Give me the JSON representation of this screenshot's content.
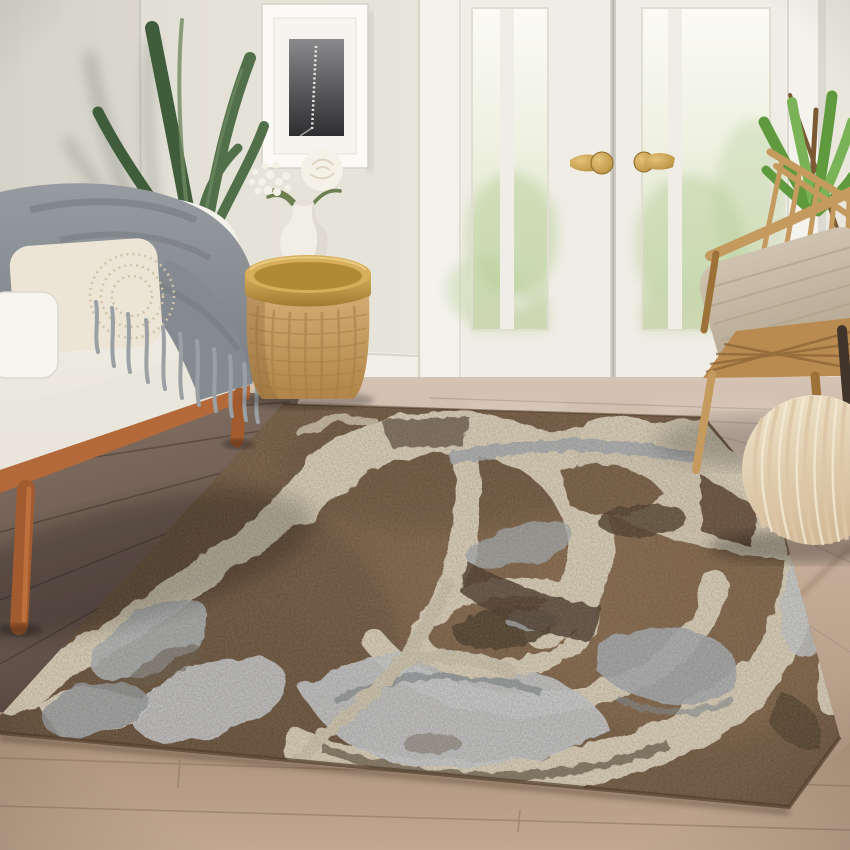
{
  "scene": {
    "type": "living-room-photograph",
    "subject": "brown abstract antler-pattern area rug styled in a bright living room",
    "objects": [
      {
        "name": "wall"
      },
      {
        "name": "wall-corner"
      },
      {
        "name": "framed-botanical-art"
      },
      {
        "name": "potted-plant-left"
      },
      {
        "name": "french-doors"
      },
      {
        "name": "garden-view"
      },
      {
        "name": "brass-door-handles"
      },
      {
        "name": "baseboard"
      },
      {
        "name": "white-loveseat"
      },
      {
        "name": "gray-knit-throw"
      },
      {
        "name": "cream-lumbar-pillow"
      },
      {
        "name": "white-side-pillow"
      },
      {
        "name": "wicker-drum-side-table"
      },
      {
        "name": "gold-tray"
      },
      {
        "name": "white-vase"
      },
      {
        "name": "white-flowers"
      },
      {
        "name": "rattan-armchair"
      },
      {
        "name": "beige-chair-cushion"
      },
      {
        "name": "potted-plant-right"
      },
      {
        "name": "knitted-pouf"
      },
      {
        "name": "wood-floor"
      },
      {
        "name": "area-rug"
      }
    ],
    "palette": {
      "wall": "#e6e3d9",
      "cornerLine": "#c9c6bb",
      "baseboard": "#f1efe7",
      "baseboardEdge": "#d8d4c8",
      "doorWhite": "#f4f2ec",
      "doorStile": "#efede5",
      "doorShadow": "#d9d5c9",
      "seam": "#b7b2a5",
      "glassTop": "#fbfbf4",
      "glassMid": "#eef0e0",
      "glassLow": "#dfe7cd",
      "lawn": "#ccd7b2",
      "tree": "#b9cf9b",
      "brassLight": "#e3c279",
      "brass": "#c29a4b",
      "brassDark": "#8c6a28",
      "floorLightTop": "#d4c2b3",
      "floorLight": "#c0a791",
      "floorDarkTop": "#8a7668",
      "floorDark": "#574840",
      "plank": "#3f332a",
      "floorBottomTop": "#a88e76",
      "floorBottom": "#c2a890",
      "plankLight": "#8d7460",
      "rugBase": "#6e5339",
      "rugDark": "#41301f",
      "rugDeep": "#2f2418",
      "rugLight": "#8d6c4b",
      "cream": "#dbd1ba",
      "creamBright": "#e9e1cd",
      "creamDim": "#cfc6b0",
      "gray": "#a3aab1",
      "grayLight": "#c6cbd0",
      "grayDark": "#7c848d",
      "grayBrown": "#6b6158",
      "sofa": "#f5f3ed",
      "sofaShade": "#e7e3d8",
      "rail": "#b4693a",
      "legWood": "#a25a2f",
      "throw": "#8d9296",
      "throwDark": "#707579",
      "fringe": "#9aa0a4",
      "pillow": "#ece5d5",
      "pillowDot": "#cfc2a8",
      "pillowWhite": "#f7f5ef",
      "wicker": "#cba46c",
      "wickerLine": "#a87f47",
      "trayGold": "#c79d47",
      "trayDark": "#97712b",
      "vase": "#f1eee6",
      "vaseShade": "#d9d5ca",
      "flower": "#f4f1e6",
      "stem": "#6d7f4e",
      "leafDark": "#3f5c3b",
      "leafMid": "#517049",
      "leafHi": "#6f8a62",
      "leafBright": "#5f9a3e",
      "leafBrightHi": "#79b257",
      "branch": "#7a5a35",
      "chairWood": "#c49a5e",
      "chairWoodDark": "#9c7238",
      "chairDarkLeg": "#41342a",
      "cushion": "#c8bba7",
      "cushionLine": "#b0a28b",
      "pouf": "#eadcc0",
      "poufShade": "#d2ba98",
      "poufLine": "#dcc6a6",
      "frameWhite": "#fbfaf6",
      "mat": "#f5f4ee",
      "imageDark": "#2e2e30",
      "imageLight": "#8a8a8c"
    }
  }
}
